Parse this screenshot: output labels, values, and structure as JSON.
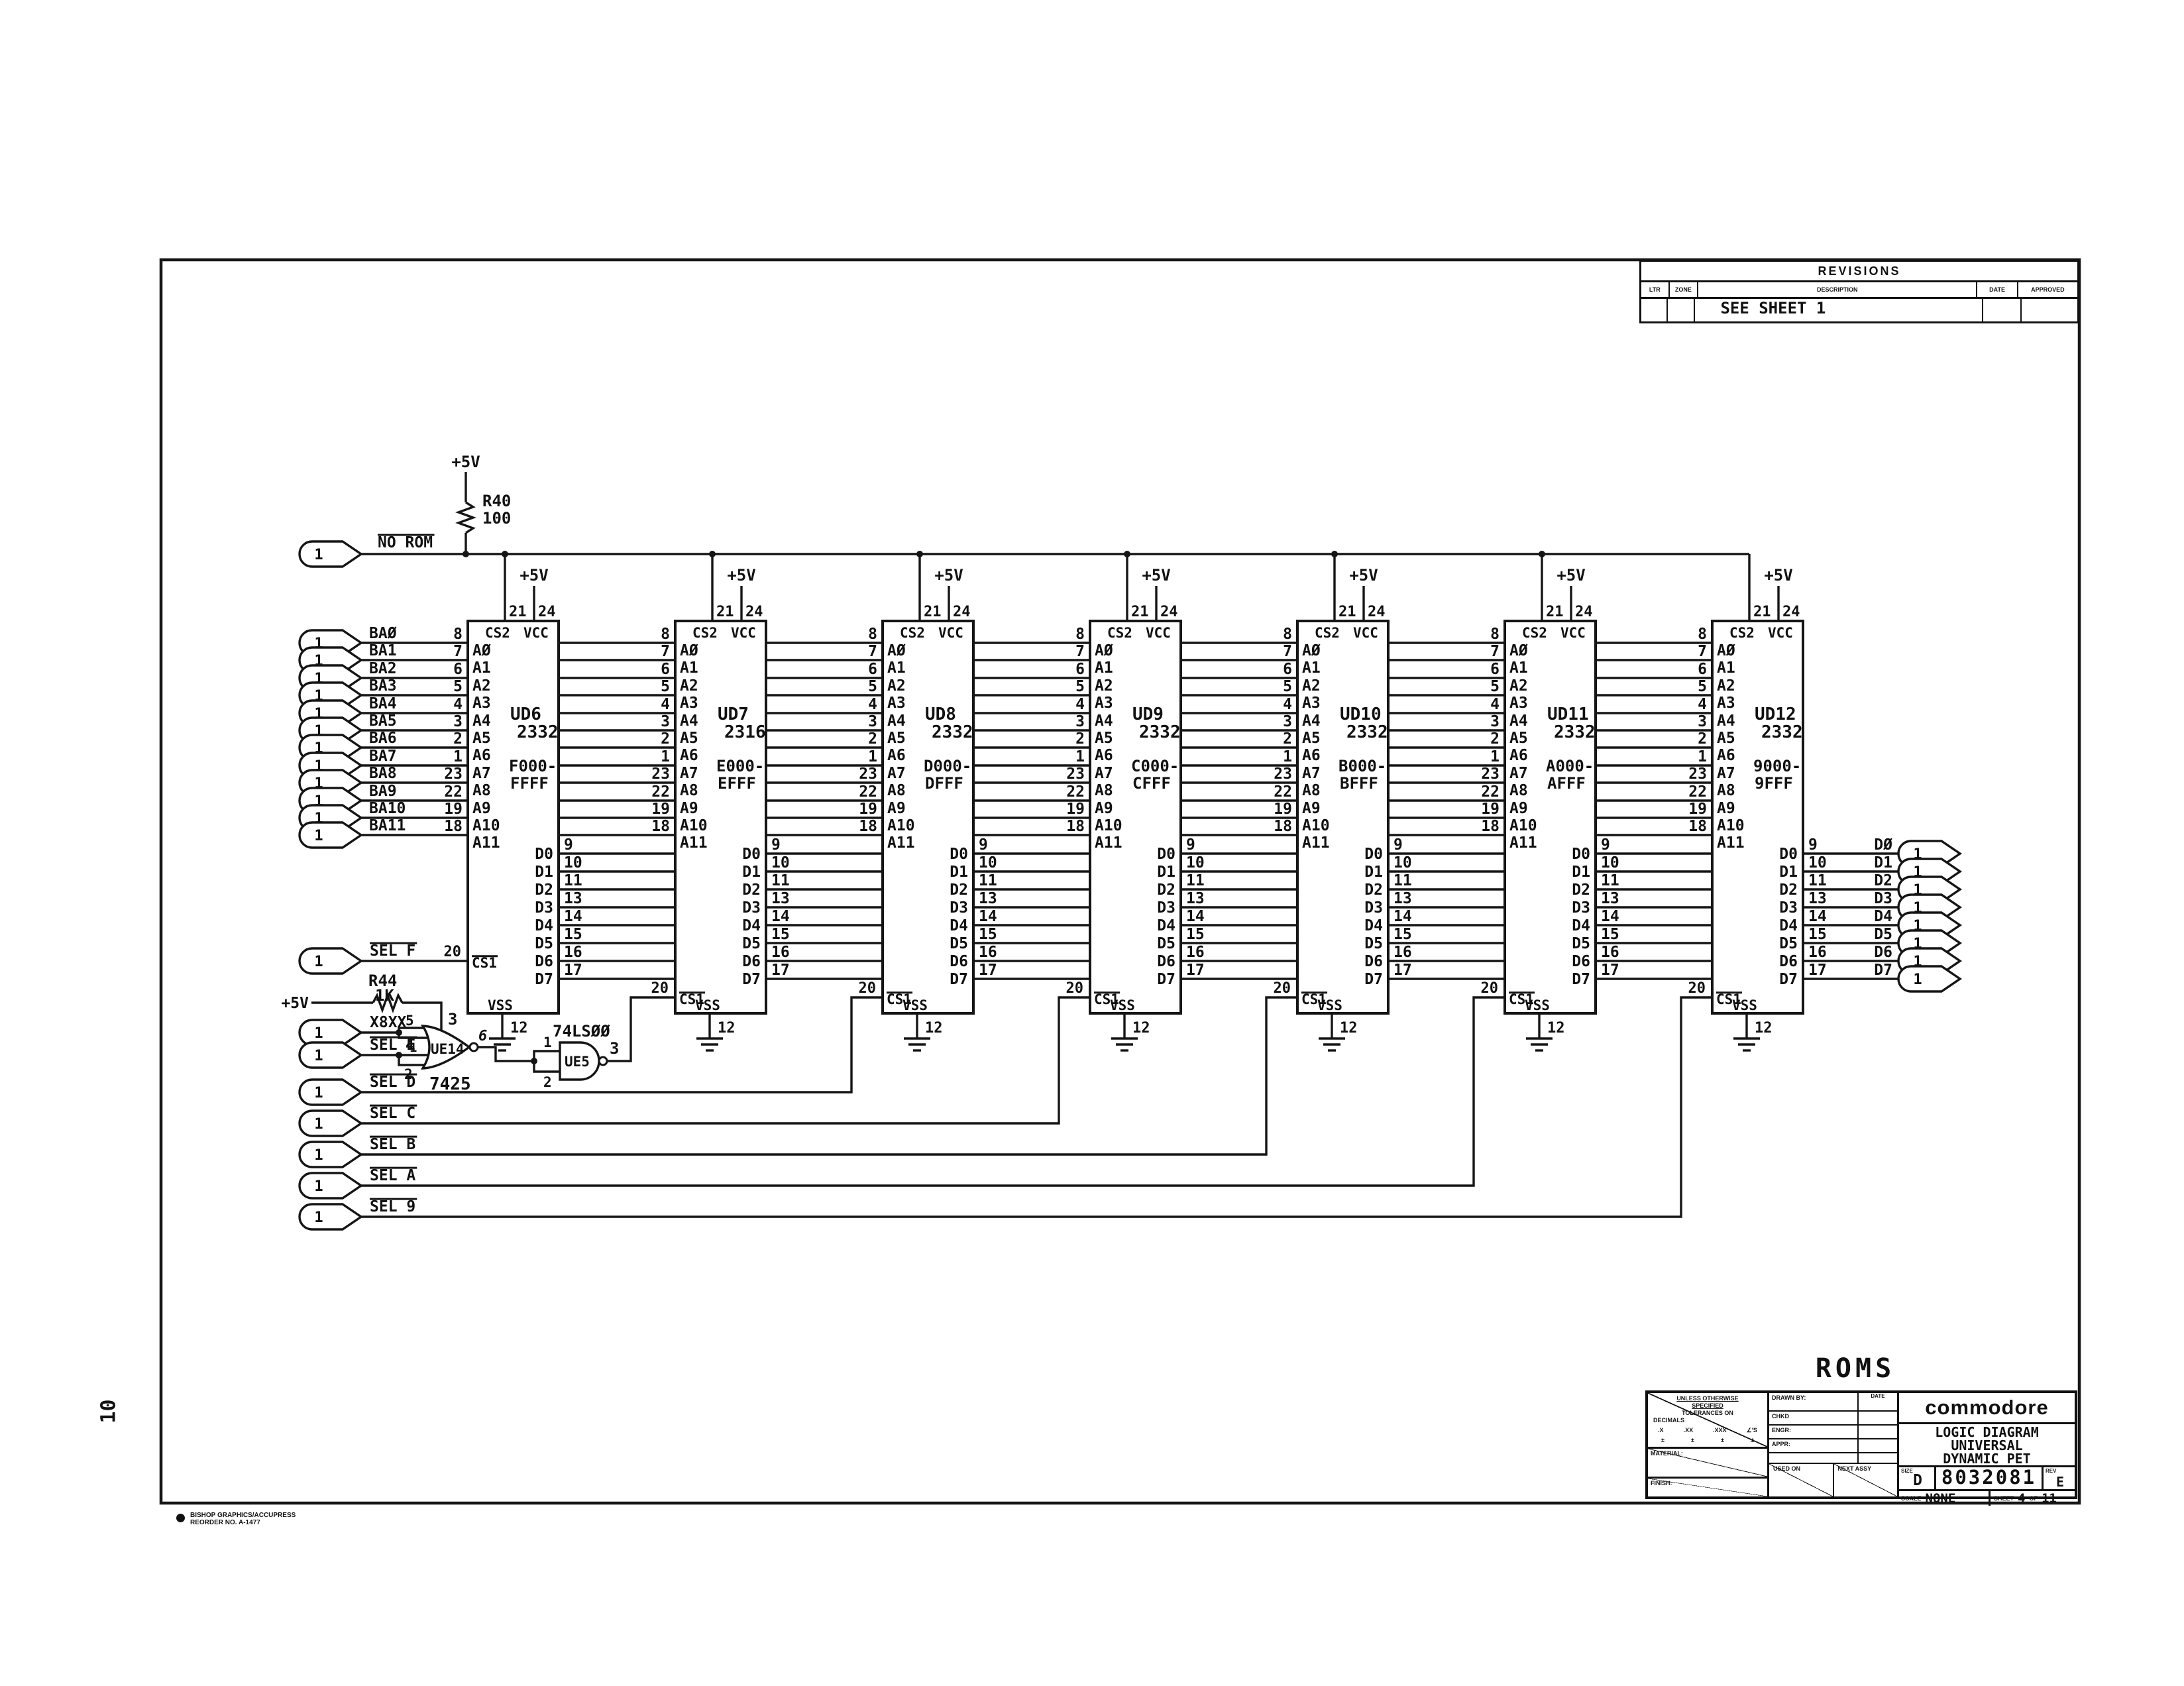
{
  "sheet": {
    "margin_number": "10",
    "corner_note_line1": "BISHOP GRAPHICS/ACCUPRESS",
    "corner_note_line2": "REORDER NO. A-1477",
    "roms_title": "ROMS"
  },
  "revisions": {
    "title": "REVISIONS",
    "columns": [
      "LTR",
      "ZONE",
      "DESCRIPTION",
      "DATE",
      "APPROVED"
    ],
    "rows": [
      {
        "ltr": "",
        "zone": "",
        "description": "SEE SHEET 1",
        "date": "",
        "approved": ""
      }
    ]
  },
  "title_block": {
    "company": "commodore",
    "doc_title_line1": "LOGIC DIAGRAM",
    "doc_title_line2": "UNIVERSAL",
    "doc_title_line3": "DYNAMIC PET",
    "size_label": "SIZE",
    "size": "D",
    "drawing_number": "8032081",
    "rev_label": "REV",
    "rev": "E",
    "scale_label": "SCALE",
    "scale": "NONE",
    "sheet_label": "SHEET",
    "sheet": "4",
    "of_label": "OF",
    "of": "11",
    "tol_line1": "UNLESS OTHERWISE",
    "tol_line2": "SPECIFIED",
    "tol_line3": "TOLERANCES ON",
    "tol_line4": "DECIMALS",
    "tol_cols": [
      ".X",
      ".XX",
      ".XXX",
      "∠'S"
    ],
    "tol_pm": "±",
    "material_label": "MATERIAL:",
    "finish_label": "FINISH:",
    "drawn_by_label": "DRAWN BY:",
    "date_label": "DATE",
    "chkd_label": "CHKD",
    "engr_label": "ENGR:",
    "appr_label": "APPR:",
    "used_on_label": "USED ON",
    "next_assy_label": "NEXT ASSY"
  },
  "power": {
    "r40": {
      "rail": "+5V",
      "ref": "R40",
      "value": "100"
    },
    "r44": {
      "rail": "+5V",
      "ref": "R44",
      "value": "1K"
    }
  },
  "no_rom": {
    "tag": "1",
    "label": "NO ROM"
  },
  "gates": {
    "nor": {
      "ref": "UE14",
      "part": "7425",
      "pin_in_a": "5",
      "pin_in_b": "4",
      "pin_in_c": "1",
      "pin_in_d": "2",
      "pin_strobe": "3",
      "pin_out": "6"
    },
    "nand": {
      "ref": "UE5",
      "part": "74LSØØ",
      "pin_in_1": "1",
      "pin_in_2": "2",
      "pin_out": "3"
    }
  },
  "chip_common": {
    "cs2_label": "CS2",
    "vcc_label": "VCC",
    "cs1_label": "CS1",
    "vss_label": "VSS",
    "pin_cs2": "21",
    "pin_vcc": "24",
    "pin_cs1": "20",
    "pin_vss": "12",
    "rail": "+5V"
  },
  "chips": [
    {
      "ref": "UD6",
      "part": "2332",
      "range1": "F000-",
      "range2": "FFFF"
    },
    {
      "ref": "UD7",
      "part": "2316",
      "range1": "E000-",
      "range2": "EFFF"
    },
    {
      "ref": "UD8",
      "part": "2332",
      "range1": "D000-",
      "range2": "DFFF"
    },
    {
      "ref": "UD9",
      "part": "2332",
      "range1": "C000-",
      "range2": "CFFF"
    },
    {
      "ref": "UD10",
      "part": "2332",
      "range1": "B000-",
      "range2": "BFFF"
    },
    {
      "ref": "UD11",
      "part": "2332",
      "range1": "A000-",
      "range2": "AFFF"
    },
    {
      "ref": "UD12",
      "part": "2332",
      "range1": "9000-",
      "range2": "9FFF"
    }
  ],
  "addr_pins": [
    {
      "label": "AØ",
      "num": "8"
    },
    {
      "label": "A1",
      "num": "7"
    },
    {
      "label": "A2",
      "num": "6"
    },
    {
      "label": "A3",
      "num": "5"
    },
    {
      "label": "A4",
      "num": "4"
    },
    {
      "label": "A5",
      "num": "3"
    },
    {
      "label": "A6",
      "num": "2"
    },
    {
      "label": "A7",
      "num": "1"
    },
    {
      "label": "A8",
      "num": "23"
    },
    {
      "label": "A9",
      "num": "22"
    },
    {
      "label": "A10",
      "num": "19"
    },
    {
      "label": "A11",
      "num": "18"
    }
  ],
  "data_pins": [
    {
      "label": "D0",
      "num": "9"
    },
    {
      "label": "D1",
      "num": "10"
    },
    {
      "label": "D2",
      "num": "11"
    },
    {
      "label": "D3",
      "num": "13"
    },
    {
      "label": "D4",
      "num": "14"
    },
    {
      "label": "D5",
      "num": "15"
    },
    {
      "label": "D6",
      "num": "16"
    },
    {
      "label": "D7",
      "num": "17"
    }
  ],
  "left_connectors": [
    {
      "tag": "1",
      "label": "BAØ"
    },
    {
      "tag": "1",
      "label": "BA1"
    },
    {
      "tag": "1",
      "label": "BA2"
    },
    {
      "tag": "1",
      "label": "BA3"
    },
    {
      "tag": "1",
      "label": "BA4"
    },
    {
      "tag": "1",
      "label": "BA5"
    },
    {
      "tag": "1",
      "label": "BA6"
    },
    {
      "tag": "1",
      "label": "BA7"
    },
    {
      "tag": "1",
      "label": "BA8"
    },
    {
      "tag": "1",
      "label": "BA9"
    },
    {
      "tag": "1",
      "label": "BA10"
    },
    {
      "tag": "1",
      "label": "BA11"
    }
  ],
  "sel_connectors": [
    {
      "tag": "1",
      "label": "SEL F",
      "overline": true
    },
    {
      "tag": "1",
      "label": "X8XX",
      "overline": false
    },
    {
      "tag": "1",
      "label": "SEL E",
      "overline": true
    },
    {
      "tag": "1",
      "label": "SEL D",
      "overline": true
    },
    {
      "tag": "1",
      "label": "SEL C",
      "overline": true
    },
    {
      "tag": "1",
      "label": "SEL B",
      "overline": true
    },
    {
      "tag": "1",
      "label": "SEL A",
      "overline": true
    },
    {
      "tag": "1",
      "label": "SEL 9",
      "overline": true
    }
  ],
  "data_connectors": [
    {
      "tag": "1",
      "label": "DØ"
    },
    {
      "tag": "1",
      "label": "D1"
    },
    {
      "tag": "1",
      "label": "D2"
    },
    {
      "tag": "1",
      "label": "D3"
    },
    {
      "tag": "1",
      "label": "D4"
    },
    {
      "tag": "1",
      "label": "D5"
    },
    {
      "tag": "1",
      "label": "D6"
    },
    {
      "tag": "1",
      "label": "D7"
    }
  ]
}
